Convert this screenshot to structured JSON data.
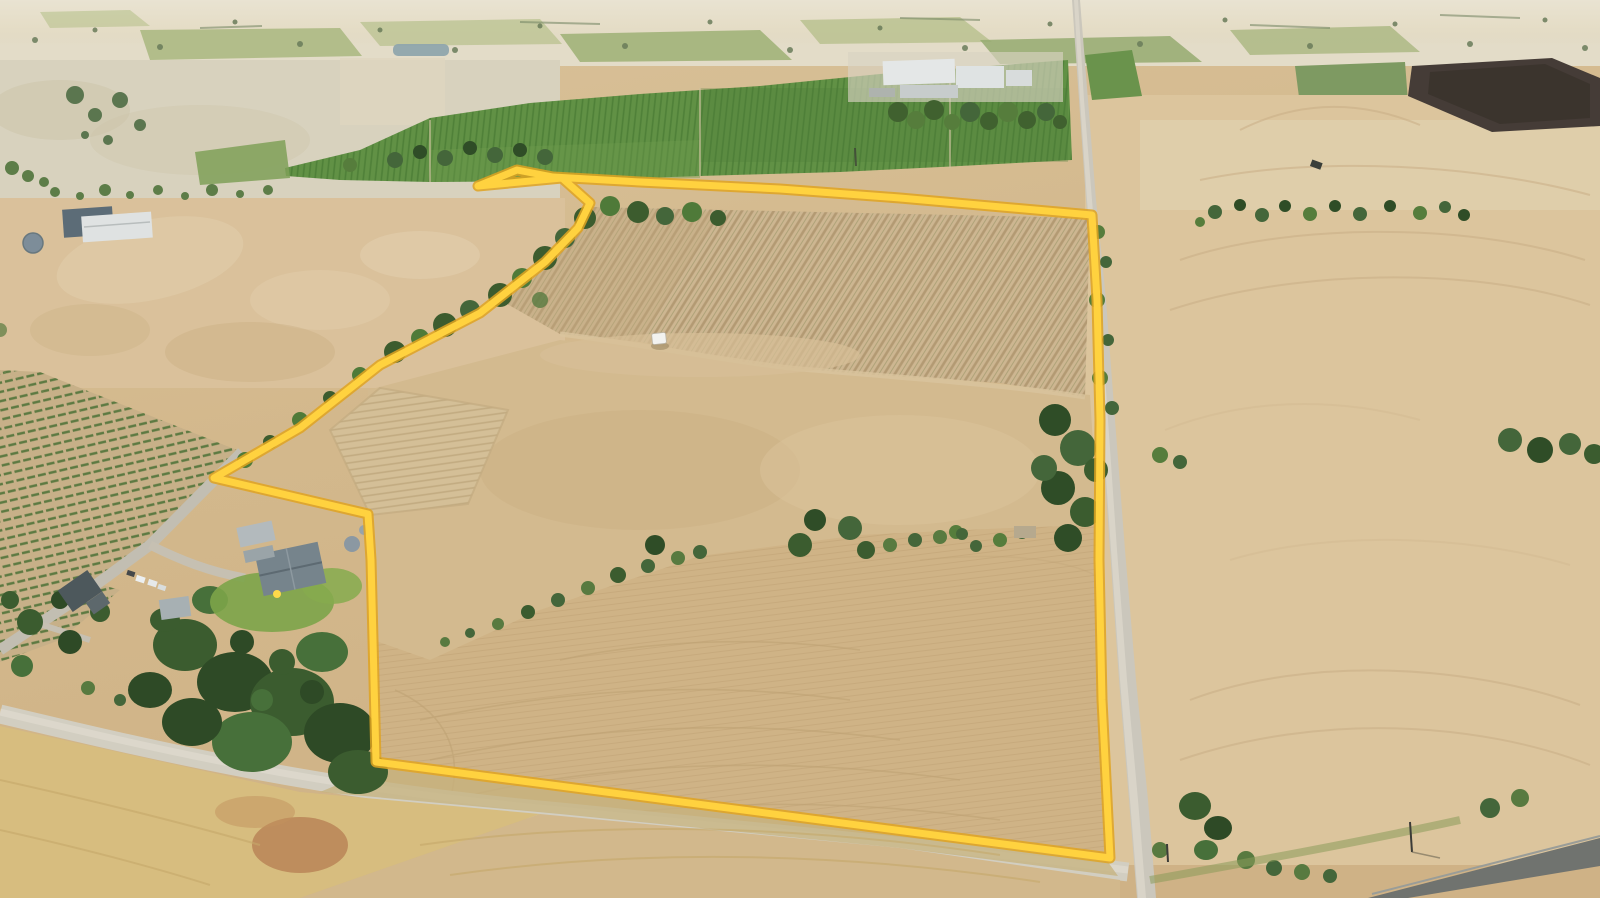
{
  "meta": {
    "title": "Aerial drone photograph of rural property for sale with highlighted lot boundary",
    "image_type": "aerial-photograph",
    "width_px": 1600,
    "height_px": 898,
    "visible_text": "none"
  },
  "boundary": {
    "name": "property-boundary-overlay",
    "stroke_color": "#FFD23F",
    "stroke_outline_color": "#DFA321",
    "stroke_width": 7,
    "outline_width": 11,
    "points_str": "478,186 517,170 553,177 640,182 780,189 900,198 1092,215 1097,300 1100,420 1099,560 1102,700 1110,858 376,762 373,640 371,560 368,514 214,478 300,428 380,365 480,313 545,262 578,228 590,203 562,178 478,186"
  },
  "palette": {
    "boundary_yellow": "#FFD23F",
    "field_tan": "#d5bc93",
    "field_pale": "#d8d2be",
    "field_light": "#dcc59d",
    "field_warm": "#cfb386",
    "field_gold": "#d7bd7f",
    "vineyard_green": "#619145",
    "pasture_green": "#9db074",
    "tree_dark": "#2f4d27",
    "tree_mid": "#44663a",
    "tree_olive": "#5d7d48",
    "road_light": "#cbc7bc",
    "road_gravel": "#d2cec1",
    "road_dark": "#70736f",
    "roof_white": "#e4e7e7",
    "roof_gray": "#76848c",
    "shed_dark": "#4d585c",
    "tank_gray": "#7d8d99",
    "water_gray": "#8fa5ad",
    "plowed_dark": "#453c37",
    "lawn_green": "#7ca449",
    "haze": "#e5decb",
    "red_soil": "#b57e52"
  },
  "scene": {
    "regions": [
      {
        "name": "distant-farmland-horizon",
        "desc": "hazy pale paddocks, hedgerows and tree specks across the top of frame"
      },
      {
        "name": "farm-dam",
        "desc": "small grey-blue water body in the middle distance"
      },
      {
        "name": "green-vineyard-blocks",
        "desc": "irrigated bright-green vine rows across upper middle"
      },
      {
        "name": "winery-complex",
        "desc": "white and grey industrial buildings upper middle"
      },
      {
        "name": "left-stubble-paddock",
        "desc": "pale grey-tan harvested paddock, upper left"
      },
      {
        "name": "machinery-sheds",
        "desc": "dark and white sheds with round tank, left side"
      },
      {
        "name": "left-vineyard-rows",
        "desc": "dotted green vine/olive rows, lower left"
      },
      {
        "name": "homestead",
        "desc": "grey hip-roof house with lawn, sheds, tanks and parked cars"
      },
      {
        "name": "garden-tree-mass",
        "desc": "dense dark eucalypt canopy below homestead"
      },
      {
        "name": "dry-vineyard-block",
        "desc": "harvested vine rows running diagonally inside boundary, upper right of lot"
      },
      {
        "name": "fallow-paddock",
        "desc": "bare tan paddock filling centre of the lot"
      },
      {
        "name": "stubble-paddock",
        "desc": "lower paddock with curved harvest tramlines"
      },
      {
        "name": "creek-tree-line",
        "desc": "scrub trees along north-west diagonal boundary"
      },
      {
        "name": "mid-paddock-tree-belt",
        "desc": "scattered trees and bushes crossing centre of lot"
      },
      {
        "name": "north-south-road",
        "desc": "light gravel road running down the right side of the lot"
      },
      {
        "name": "southern-gravel-road",
        "desc": "gravel road along the bottom boundary"
      },
      {
        "name": "sealed-road-corner",
        "desc": "dark bitumen road crossing bottom-right corner"
      },
      {
        "name": "right-wheat-paddock",
        "desc": "large cream wheat paddock with curved tramlines, right of road"
      },
      {
        "name": "dark-plowed-field",
        "desc": "very dark cultivated field, top right"
      },
      {
        "name": "white-caravan",
        "desc": "small white vehicle parked at vineyard headland"
      }
    ]
  }
}
